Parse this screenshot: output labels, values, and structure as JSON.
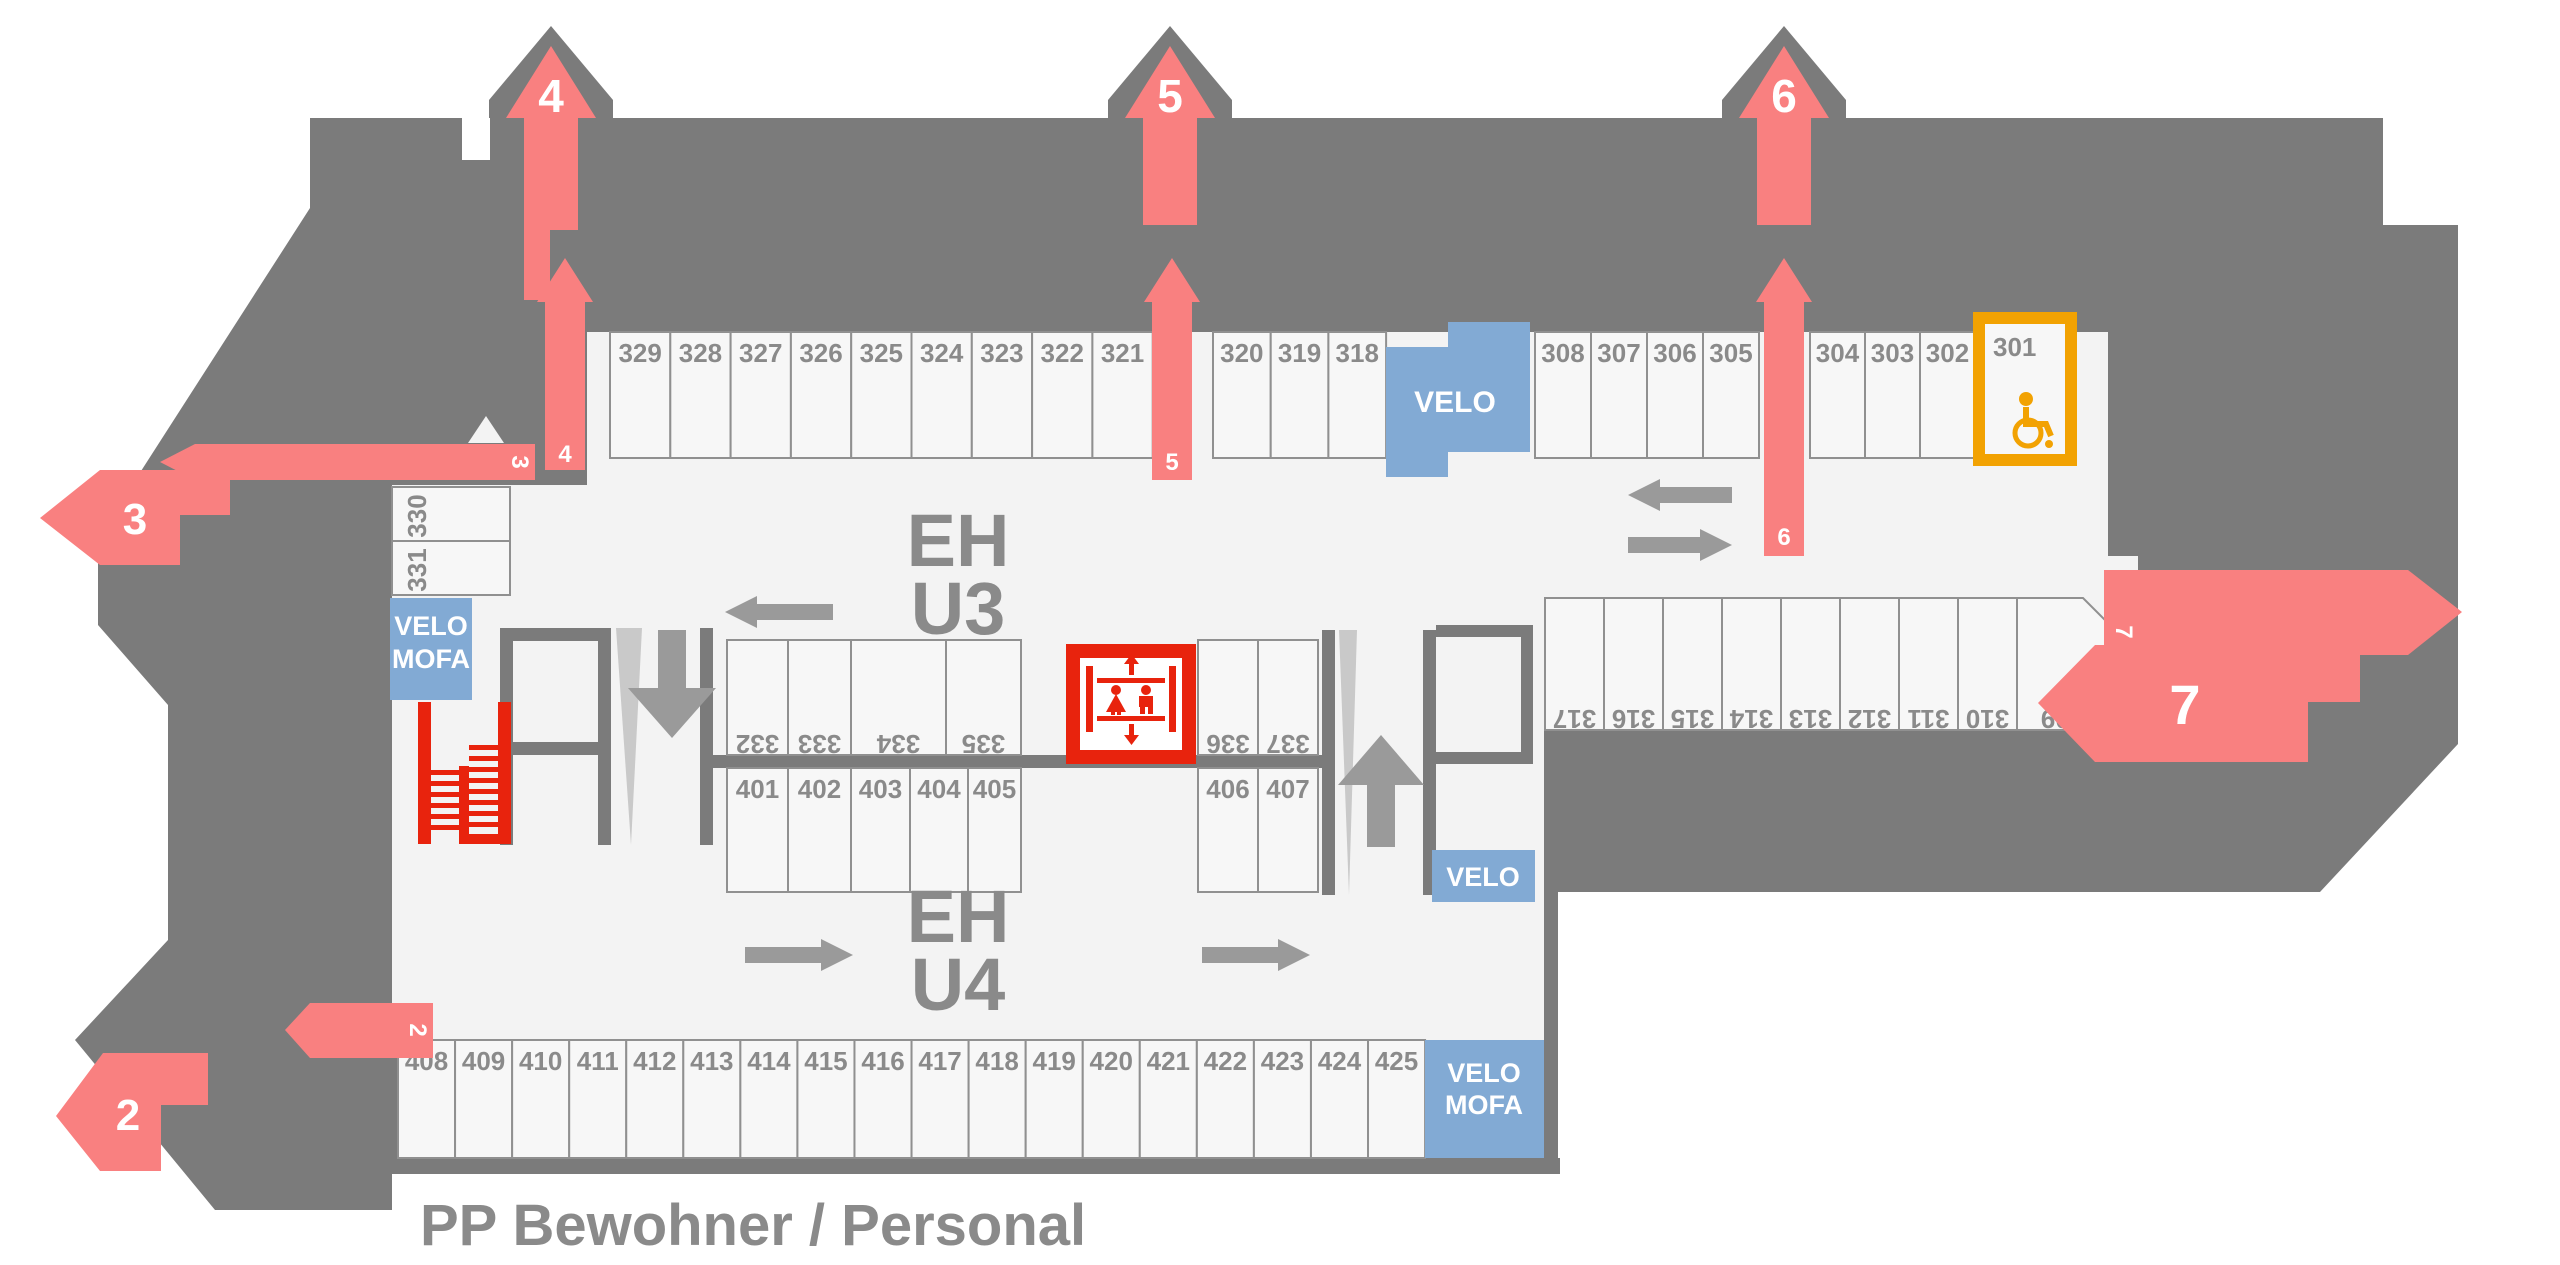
{
  "title": "PP Bewohner / Personal",
  "floor_labels": {
    "upper_line1": "EH",
    "upper_line2": "U3",
    "lower_line1": "EH",
    "lower_line2": "U4"
  },
  "entrances": {
    "e2_big": "2",
    "e2_small": "2",
    "e3_big": "3",
    "e3_small": "3",
    "e4_top": "4",
    "e4_inner": "4",
    "e5_top": "5",
    "e5_inner": "5",
    "e6_top": "6",
    "e6_inner": "6",
    "e7_big": "7",
    "e7_small": "7"
  },
  "areas": {
    "velo_top": "VELO",
    "velo_mofa_left_1": "VELO",
    "velo_mofa_left_2": "MOFA",
    "velo_small": "VELO",
    "velo_mofa_bottom_1": "VELO",
    "velo_mofa_bottom_2": "MOFA"
  },
  "spots": {
    "top_a": [
      "329",
      "328",
      "327",
      "326",
      "325",
      "324",
      "323",
      "322",
      "321"
    ],
    "top_b": [
      "320",
      "319",
      "318"
    ],
    "top_c": [
      "308",
      "307",
      "306",
      "305"
    ],
    "top_d": [
      "304",
      "303",
      "302"
    ],
    "handicap": "301",
    "left_col": [
      "330",
      "331"
    ],
    "mid_top": [
      "332",
      "333",
      "334",
      "335"
    ],
    "mid_top_b": [
      "336",
      "337"
    ],
    "mid_bottom": [
      "401",
      "402",
      "403",
      "404",
      "405"
    ],
    "mid_bottom_b": [
      "406",
      "407"
    ],
    "right_row": [
      "317",
      "316",
      "315",
      "314",
      "313",
      "312",
      "311",
      "310",
      "309"
    ],
    "bottom": [
      "408",
      "409",
      "410",
      "411",
      "412",
      "413",
      "414",
      "415",
      "416",
      "417",
      "418",
      "419",
      "420",
      "421",
      "422",
      "423",
      "424",
      "425"
    ]
  },
  "icons": {
    "elevator": "elevator-icon",
    "stairs": "stairs-icon",
    "wheelchair": "wheelchair-icon",
    "ramp_down": "ramp-down-arrow-icon",
    "ramp_up": "ramp-up-arrow-icon"
  },
  "colors": {
    "building": "#7b7b7b",
    "floor": "#f3f3f3",
    "cell": "#f7f7f7",
    "cell_border": "#909090",
    "pink": "#f98080",
    "red": "#e8230d",
    "blue": "#82aad4",
    "orange": "#f2a202",
    "label_gray": "#8a8a8a",
    "arrow_gray": "#9a9a9a",
    "ramp_light": "#c9c9c9"
  }
}
